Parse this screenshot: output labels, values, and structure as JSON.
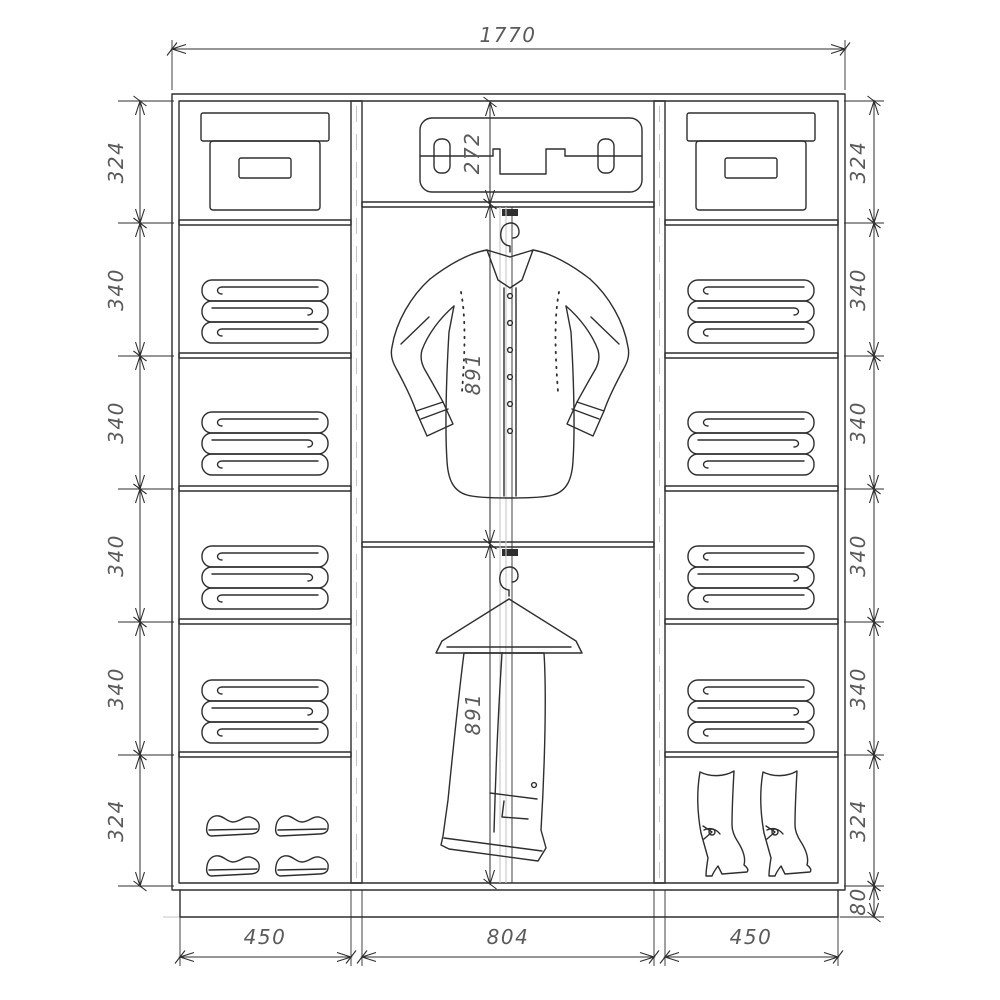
{
  "diagram": {
    "type": "technical-drawing",
    "subject": "Sliding wardrobe interior layout with dimension chains",
    "total_width_label": "1770",
    "left_section_heights": [
      "324",
      "340",
      "340",
      "340",
      "340",
      "324"
    ],
    "right_section_heights": [
      "324",
      "340",
      "340",
      "340",
      "340",
      "324"
    ],
    "plinth_height_label": "80",
    "top_center_height_label": "272",
    "hanging_zone_labels": [
      "891",
      "891"
    ],
    "bottom_section_widths": [
      "450",
      "804",
      "450"
    ],
    "icons": [
      "storage-box-icon",
      "folded-clothes-icon",
      "suitcase-icon",
      "hanger-hook-icon",
      "shirt-on-hanger-icon",
      "trousers-on-hanger-icon",
      "dress-shoe-icon",
      "heeled-boot-icon"
    ],
    "colors": {
      "line": "#2e2e2e",
      "dim_text": "#5a5a5a",
      "light_line": "#c6c6c6",
      "background": "#ffffff"
    }
  }
}
